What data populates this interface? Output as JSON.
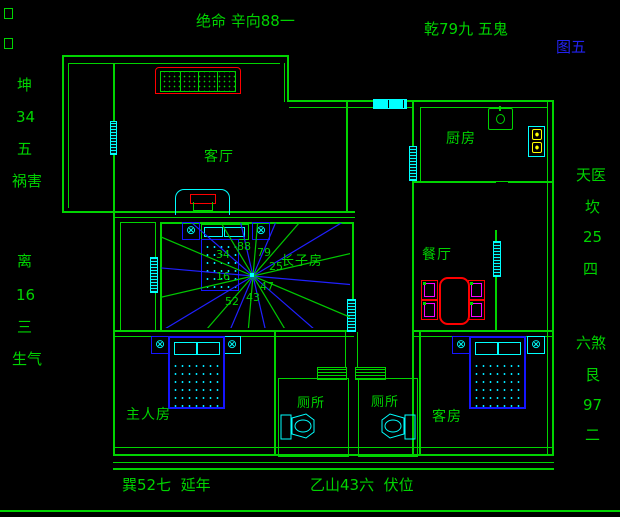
{
  "figure": {
    "tag": "图五"
  },
  "perimeter": {
    "top": "绝命 辛向88一",
    "top_right": "乾79九 五鬼",
    "bottom_left": "巽52七  延年",
    "bottom_right": "乙山43六  伏位",
    "left_upper": [
      "坤",
      "34",
      "五",
      "祸害"
    ],
    "left_lower": [
      "离",
      "16",
      "三",
      "生气"
    ],
    "right_upper": [
      "天医",
      "坎",
      "25",
      "四"
    ],
    "right_lower": [
      "六煞",
      "艮",
      "97",
      "二"
    ]
  },
  "rooms": {
    "living_room": "客厅",
    "kitchen": "厨房",
    "dining_room": "餐厅",
    "eldest_son_room": "长子房",
    "master_bedroom": "主人房",
    "toilet_left": "厕所",
    "toilet_right": "厕所",
    "guest_room": "客房"
  },
  "compass_numbers": [
    "88",
    "79",
    "25",
    "47",
    "43",
    "52",
    "34",
    "16"
  ],
  "colors": {
    "wall_green": "#00d400",
    "window_cyan": "#00ffff",
    "highlight_red": "#ff0000",
    "furniture_blue": "#1515ff",
    "figure_tag_blue": "#2222ee",
    "burner_yellow": "#ffff00",
    "chair_accent_magenta": "#ff00ff",
    "compass_ray_blue": "#2020ff",
    "compass_ray_green": "#00c800"
  }
}
